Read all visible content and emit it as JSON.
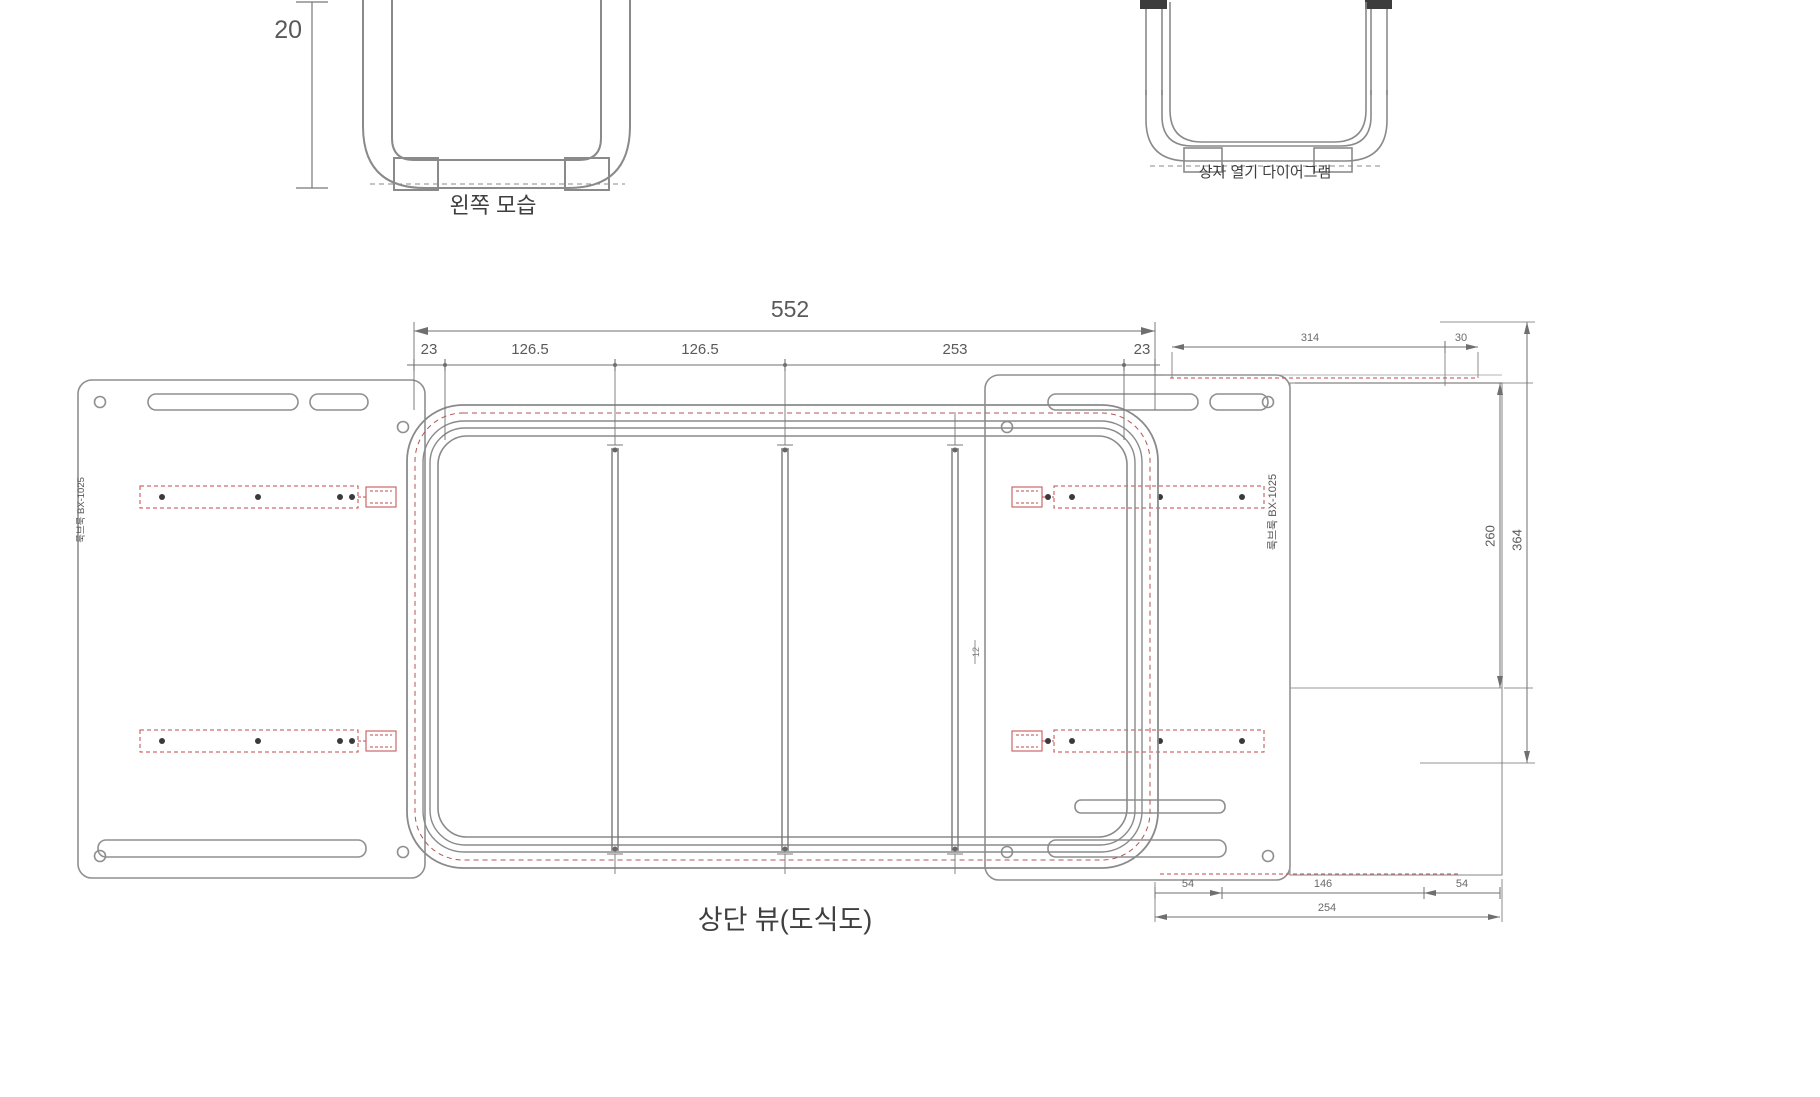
{
  "drawing": {
    "left_view": {
      "label": "왼쪽 모습",
      "height_dim": "20"
    },
    "open_diagram": {
      "label": "상자 열기 다이어그램"
    },
    "top_view": {
      "label": "상단 뷰(도식도)",
      "total_width": "552",
      "seg": [
        "23",
        "126.5",
        "126.5",
        "253",
        "23"
      ],
      "inner_dim": "12",
      "left_panel_label": "룩브룩 BX-1025",
      "right_panel_label": "룩브룩 BX-1025"
    },
    "right_panel_dims": {
      "top_width": "314",
      "top_offset": "30",
      "bottom_seg": [
        "54",
        "146",
        "54"
      ],
      "bottom_total": "254",
      "height_inner": "260",
      "height_outer": "364"
    }
  },
  "colors": {
    "line": "#8a8a8a",
    "dim_line": "#777777",
    "text": "#4a4a4a",
    "accent_red": "#c24a4a",
    "cap_dark": "#3c3c3c"
  }
}
